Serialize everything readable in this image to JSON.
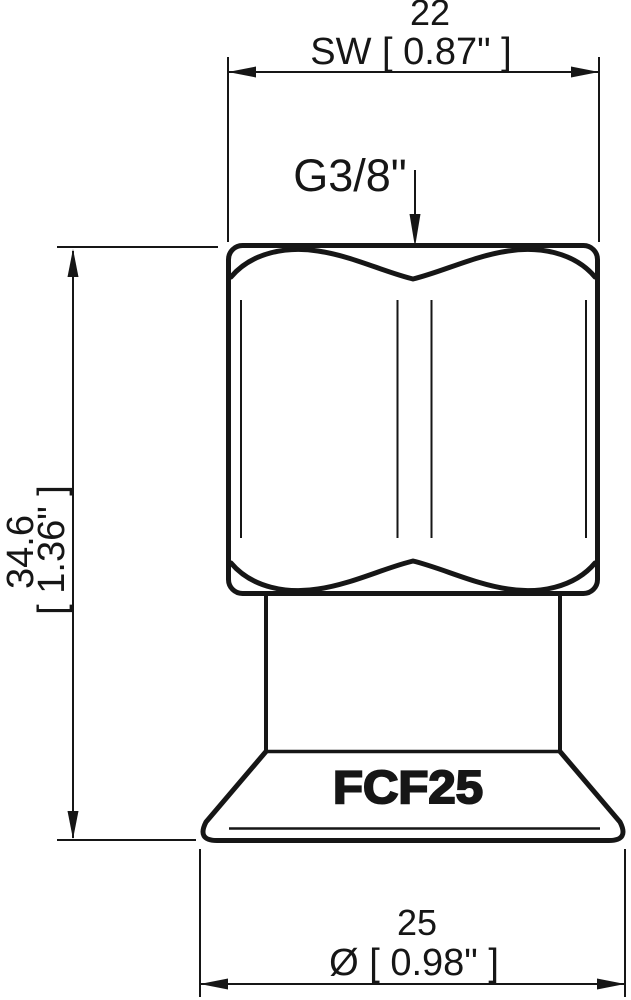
{
  "drawing": {
    "type": "technical-dimension-drawing",
    "product_code": "FCF25",
    "thread_label": "G3/8\"",
    "dim_sw": {
      "mm": "22",
      "inch_label": "SW [ 0.87\" ]"
    },
    "dim_height": {
      "mm": "34.6",
      "inch": "[ 1.36\" ]"
    },
    "dim_diameter": {
      "mm": "25",
      "inch_label": "Ø [ 0.98\" ]"
    },
    "colors": {
      "line": "#161616",
      "background": "#ffffff"
    }
  }
}
